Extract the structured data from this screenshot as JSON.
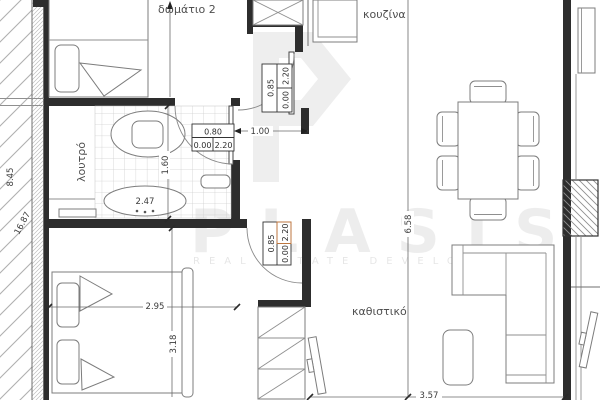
{
  "plan": {
    "rooms": [
      {
        "id": "bedroom-2",
        "label": "δωμάτιο 2"
      },
      {
        "id": "kitchen",
        "label": "κουζίνα"
      },
      {
        "id": "bathroom",
        "label": "λουτρό"
      },
      {
        "id": "living-room",
        "label": "καθιστικό"
      }
    ],
    "dimensions": {
      "hall_width": "1.00",
      "bath_length": "1.60",
      "bath_width": "2.47",
      "bedroom_width": "2.95",
      "bedroom_length": "3.18",
      "living_width": "3.57",
      "living_length": "6.58",
      "side_upper": "8.45",
      "side_total": "16.87"
    },
    "doors": {
      "bath": {
        "width": "0.80",
        "sill": "0.00",
        "height": "2.20"
      },
      "kitchen": {
        "width": "0.85",
        "sill": "0.00",
        "height": "2.20"
      },
      "bedroom": {
        "width": "0.85",
        "sill": "0.00",
        "height": "2.20"
      }
    }
  },
  "watermark": {
    "name": "PLASIS",
    "tagline": "REAL ESTATE DEVELOPMENT"
  },
  "colors": {
    "wall": "#2d2d2d",
    "hatch": "#b0b0b0",
    "tile": "#cfcfcf",
    "furniture_line": "#7c7c7c",
    "dimension_text": "#3c3c3c",
    "label_text": "#4f4f4f",
    "highlight": "#c97c3f",
    "watermark": "rgba(0,0,0,0.07)"
  }
}
